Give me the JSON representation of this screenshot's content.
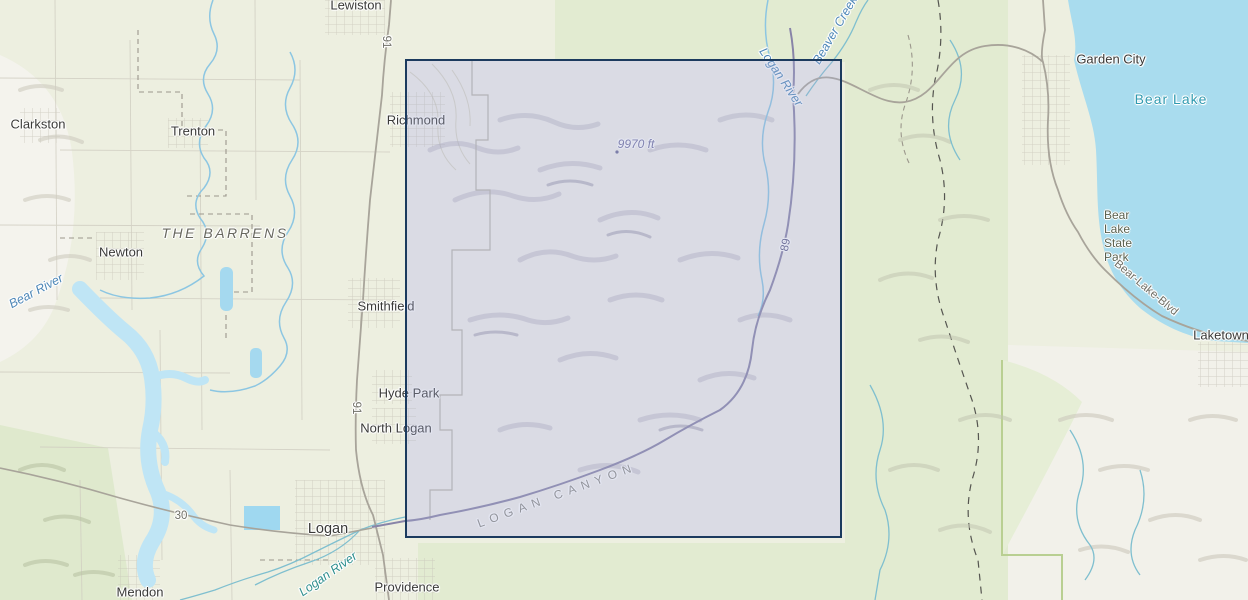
{
  "map_title": "Topographic basemap of Cache Valley and Bear Lake area with selection box over Logan Canyon",
  "labels": {
    "towns": [
      "Lewiston",
      "Clarkston",
      "Trenton",
      "Richmond",
      "Newton",
      "Smithfield",
      "Hyde Park",
      "North Logan",
      "Logan",
      "Mendon",
      "Providence",
      "Garden City",
      "Laketown"
    ],
    "water": {
      "bear_lake": "Bear Lake",
      "logan_river_upper": "Logan River",
      "beaver_creek": "Beaver Creek",
      "bear_river": "Bear River",
      "logan_river_lower": "Logan River"
    },
    "areas": {
      "barrens": "THE BARRENS",
      "logan_canyon": "LOGAN CANYON",
      "state_park_lines": [
        "Bear",
        "Lake",
        "State",
        "Park"
      ]
    },
    "roads": {
      "us91_north": "91",
      "us91_south": "91",
      "sr30": "30",
      "us89": "89",
      "bear_lake_blvd": "Bear-Lake-Blvd"
    },
    "elevation": {
      "peak": "9970 ft"
    }
  },
  "colors": {
    "valley_beige": "#edefe0",
    "forest_green": "#e2ebd1",
    "mountain_white": "#f1f0eb",
    "lake_blue": "#a9dcee",
    "reservoir_blue": "#bfe5f5",
    "selection_border": "#1b3a5e",
    "selection_fill": "rgba(165,172,212,0.30)",
    "town_label": "#3a3a38",
    "river_label_blue": "#4e87b7",
    "river_label_teal": "#2f8f8e",
    "lake_label": "#2f9ab0",
    "highway_purple": "#8884a8",
    "road_gray": "#a8a49a"
  }
}
